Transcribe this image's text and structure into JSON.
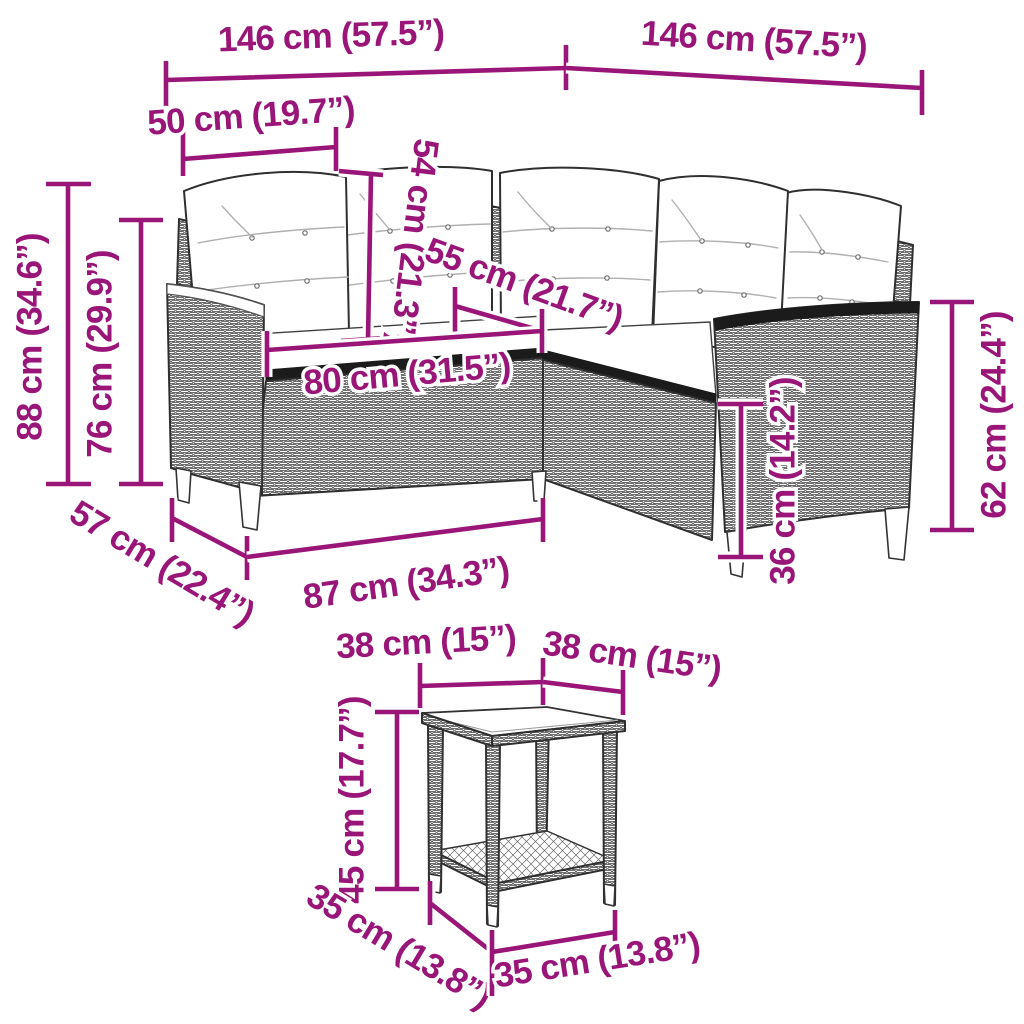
{
  "figure": {
    "kind": "product dimension diagram",
    "background": "#ffffff",
    "colors": {
      "dimension_accent": "#9a1578",
      "line_art": "#2f2f2f"
    }
  },
  "labels": {
    "sofa": {
      "back_width_left": "146 cm (57.5”)",
      "back_width_right": "146 cm (57.5”)",
      "arm_depth": "50 cm (19.7”)",
      "cushion_height": "54 cm (21.3”)",
      "corner_seat_width": "55 cm (21.7”)",
      "seat_width": "80 cm (31.5”)",
      "overall_height": "88 cm (34.6”)",
      "backrest_height": "76 cm (29.9”)",
      "depth": "57 cm (22.4”)",
      "front_width": "87 cm (34.3”)",
      "seat_height": "36 cm (14.2”)",
      "arm_height": "62 cm (24.4”)"
    },
    "table": {
      "top_width_left": "38 cm (15”)",
      "top_width_right": "38 cm (15”)",
      "height": "45 cm (17.7”)",
      "base_depth": "35 cm (13.8”)",
      "base_width": "35 cm (13.8”)"
    }
  }
}
